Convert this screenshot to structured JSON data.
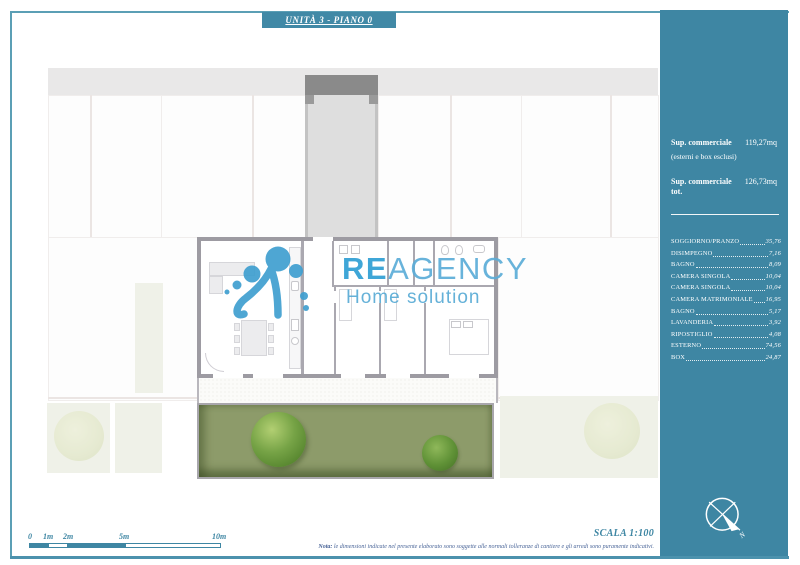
{
  "header": {
    "title": "UNITÀ 3 - PIANO 0"
  },
  "watermark": {
    "brand_bold": "RE",
    "brand_rest": "AGENCY",
    "tagline": "Home solution",
    "logo_blue": "#3f9fd0"
  },
  "sidebar": {
    "summary_label": "Sup. commerciale",
    "summary_value": "119,27mq",
    "summary_note": "(esterni e box esclusi)",
    "total_label": "Sup. commerciale tot.",
    "total_value": "126,73mq",
    "rooms": [
      {
        "name": "SOGGIORNO/PRANZO",
        "area": "35,76"
      },
      {
        "name": "DISIMPEGNO",
        "area": "7,16"
      },
      {
        "name": "BAGNO",
        "area": "8,09"
      },
      {
        "name": "CAMERA SINGOLA",
        "area": "10,04"
      },
      {
        "name": "CAMERA SINGOLA",
        "area": "10,04"
      },
      {
        "name": "CAMERA MATRIMONIALE",
        "area": "16,95"
      },
      {
        "name": "BAGNO",
        "area": "5,17"
      },
      {
        "name": "LAVANDERIA",
        "area": "3,92"
      },
      {
        "name": "RIPOSTIGLIO",
        "area": "4,08"
      },
      {
        "name": "ESTERNO",
        "area": "74,56"
      },
      {
        "name": "BOX",
        "area": "24,87"
      }
    ],
    "compass_label": "N",
    "panel_color": "#3e86a3"
  },
  "footer": {
    "scale_labels": [
      "0",
      "1m",
      "2m",
      "5m",
      "10m"
    ],
    "scale_text": "SCALA 1:100",
    "note_bold": "Nota:",
    "note_rest": " le dimensioni indicate nel presente elaborato sono soggette alle normali tolleranze di cantiere e gli arredi sono puramente indicativi."
  },
  "colors": {
    "accent": "#3e86a3",
    "garden_green": "#8d9b6a"
  }
}
